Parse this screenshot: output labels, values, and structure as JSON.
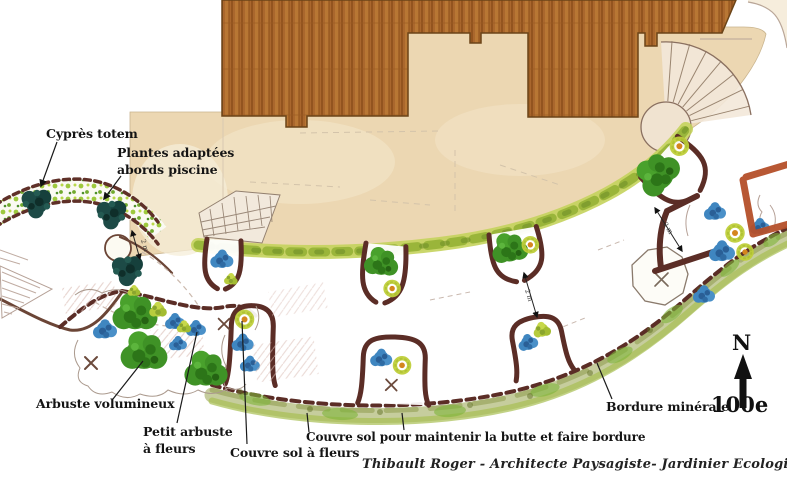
{
  "plan": {
    "labels": {
      "cypres_totem": "Cyprès totem",
      "plantes_adaptees_1": "Plantes adaptées",
      "plantes_adaptees_2": "abords piscine",
      "arbuste_volumineux": "Arbuste volumineux",
      "petit_arbuste_1": "Petit arbuste",
      "petit_arbuste_2": "à fleurs",
      "couvre_sol_fleurs": "Couvre sol à fleurs",
      "couvre_sol_butte": "Couvre sol pour maintenir la butte et faire bordure",
      "bordure_minerale": "Bordure minérale"
    },
    "compass": {
      "north": "N",
      "scale": "100e"
    },
    "dimension_label": "2 m",
    "credit": "Thibault Roger - Architecte Paysagiste- Jardinier Ecologique- Décembre 2014",
    "colors": {
      "roof_brown": "#a9662c",
      "terrace_beige": "#ecd7b2",
      "foliage_green": "#3f9226",
      "flower_blue": "#3f86c0",
      "flower_orange": "#d4861e",
      "border_maroon": "#5b2d26",
      "terracotta": "#b5502a",
      "ground_cover_olive": "#97a63e",
      "cypress_teal": "#1d4a46"
    }
  }
}
